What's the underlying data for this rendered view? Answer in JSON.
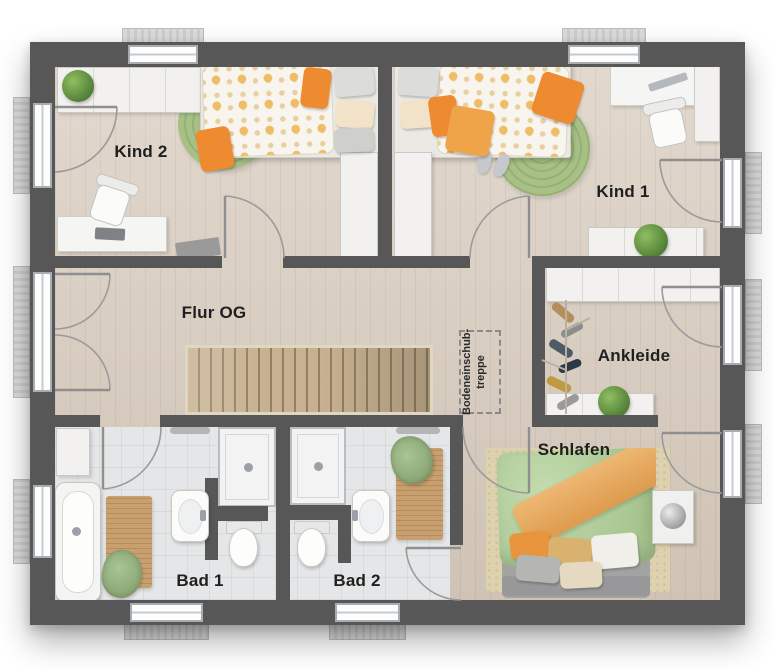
{
  "rooms": {
    "kind2": {
      "label": "Kind 2"
    },
    "kind1": {
      "label": "Kind 1"
    },
    "flur": {
      "label": "Flur OG"
    },
    "ankleide": {
      "label": "Ankleide"
    },
    "schlafen": {
      "label": "Schlafen"
    },
    "bad1": {
      "label": "Bad 1"
    },
    "bad2": {
      "label": "Bad 2"
    }
  },
  "annotations": {
    "attic": {
      "line1": "Bodeneinschub-",
      "line2": "treppe"
    }
  },
  "colors": {
    "wall": "#575757",
    "floor_wood": "#d8cbbd",
    "tile": "#e5e6e7",
    "stairs_wood": "#c7b191",
    "rug_green": "#a7c086",
    "accent_orange": "#ee8a2f",
    "duvet_green": "#b4cf9e",
    "blanket_orange": "#e6a75e",
    "label_text": "#1f1f1f"
  }
}
